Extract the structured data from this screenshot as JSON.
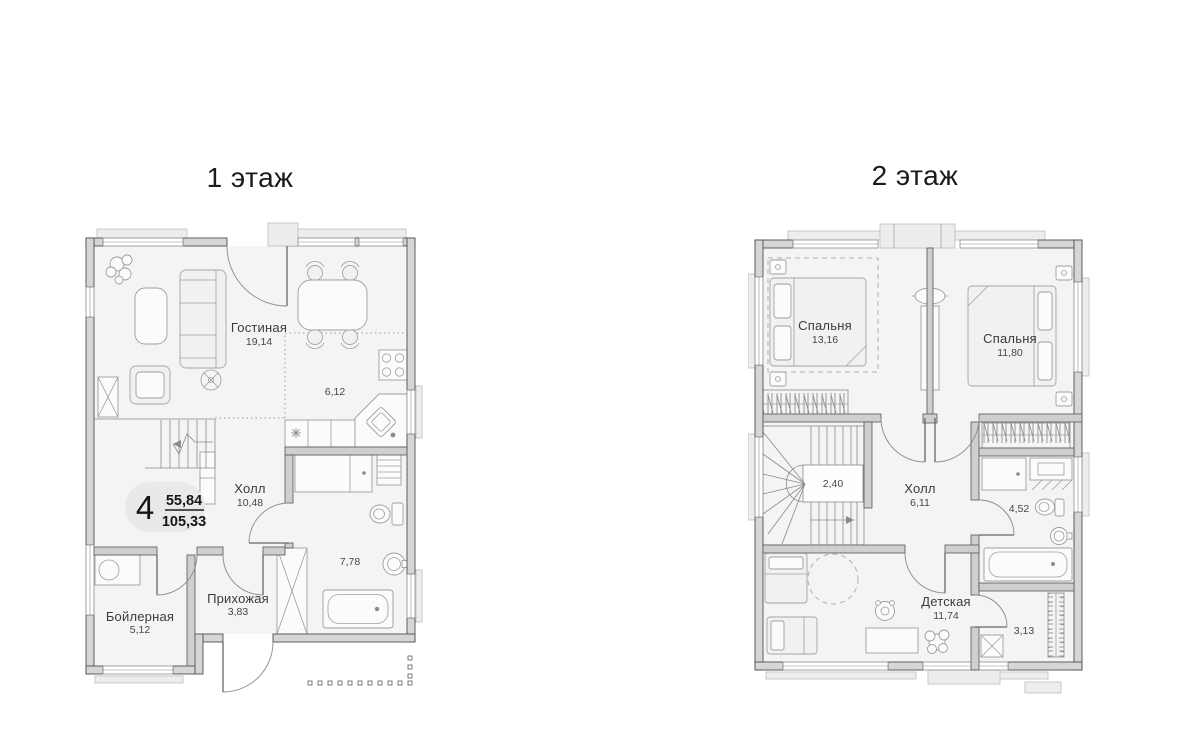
{
  "floor1": {
    "title": "1 этаж",
    "badge": {
      "rooms_count": "4",
      "living_area": "55,84",
      "total_area": "105,33"
    },
    "rooms": {
      "living": {
        "name": "Гостиная",
        "area": "19,14"
      },
      "kitchen": {
        "area": "6,12"
      },
      "hall": {
        "name": "Холл",
        "area": "10,48"
      },
      "bathroom": {
        "area": "7,78"
      },
      "entry": {
        "name": "Прихожая",
        "area": "3,83"
      },
      "boiler": {
        "name": "Бойлерная",
        "area": "5,12"
      }
    }
  },
  "floor2": {
    "title": "2 этаж",
    "rooms": {
      "bedroom1": {
        "name": "Спальня",
        "area": "13,16"
      },
      "bedroom2": {
        "name": "Спальня",
        "area": "11,80"
      },
      "stairs": {
        "area": "2,40"
      },
      "hall": {
        "name": "Холл",
        "area": "6,11"
      },
      "bathroom": {
        "area": "4,52"
      },
      "kids": {
        "name": "Детская",
        "area": "11,74"
      },
      "closet": {
        "area": "3,13"
      }
    }
  },
  "colors": {
    "wall_fill": "#d6d6d6",
    "wall_line": "#4f4f4f",
    "floor_fill": "#f4f4f4",
    "furniture_line": "#9e9e9e",
    "label_text": "#3b3b3b",
    "badge_bg": "#e9e9e9"
  }
}
